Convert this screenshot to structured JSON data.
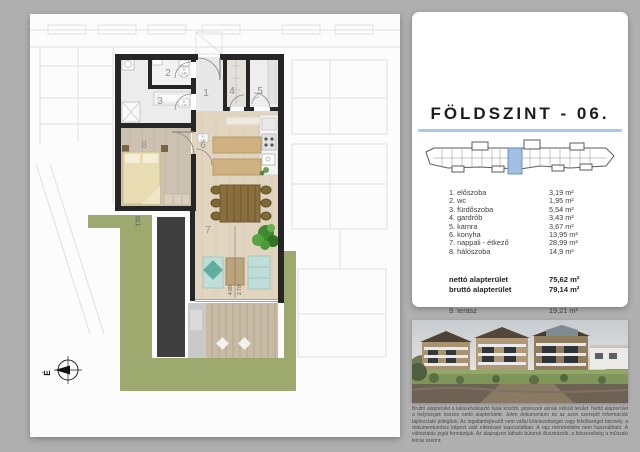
{
  "colors": {
    "background_gray": "#afafaf",
    "accent_blue": "#a9c9e4",
    "keyplan_highlight": "#9fc0e2",
    "floorplan_green": "#9da96e"
  },
  "panel": {
    "title": "FÖLDSZINT - 06.",
    "rooms": [
      {
        "label": "1. előszoba",
        "area": "3,19 m²"
      },
      {
        "label": "2. wc",
        "area": "1,95 m²"
      },
      {
        "label": "3. fürdőszoba",
        "area": "5,54 m²"
      },
      {
        "label": "4. gardrób",
        "area": "3,43 m²"
      },
      {
        "label": "5. kamra",
        "area": "3,67 m²"
      },
      {
        "label": "6. konyha",
        "area": "13,95 m²"
      },
      {
        "label": "7. nappali - étkező",
        "area": "28,99 m²"
      },
      {
        "label": "8. hálószoba",
        "area": "14,9 m²"
      }
    ],
    "totals": {
      "netto_label": "nettó alapterület",
      "netto_area": "75,62 m²",
      "brutto_label": "bruttó alapterület",
      "brutto_area": "79,14 m²"
    },
    "terrace": {
      "label": "9. terasz",
      "area": "19,21 m²"
    }
  },
  "floorplan": {
    "room_numbers": [
      "1",
      "2",
      "3",
      "4",
      "5",
      "6",
      "7",
      "8"
    ],
    "dimensions": {
      "living_width": "4,90",
      "living_clear": "2,70",
      "garden_strip": "1,50"
    },
    "door_size": {
      "w": "90",
      "h": "2,10"
    },
    "compass_letter": "É"
  },
  "disclaimer": "Bruttó alapterület a lakáselválasztó falak közötti, gépészeti aknák nélküli terület. Nettó alapterület a helyiségek összes nettó alapterülete. Jelen dokumentum és az azon szereplő információk tájékoztató jellegűek. Az ingatlanfejlesztő nem vállal kötelezettséget vagy felelősséget bármely, a dokumentumhoz képest való eltéréssel kapcsolatban. A rajz méretvételre nem használható. A változtatás jogát fenntartjuk. Az alaprajzon látható bútorok illusztrációk, a felszereltség a műszaki leírás szerint."
}
